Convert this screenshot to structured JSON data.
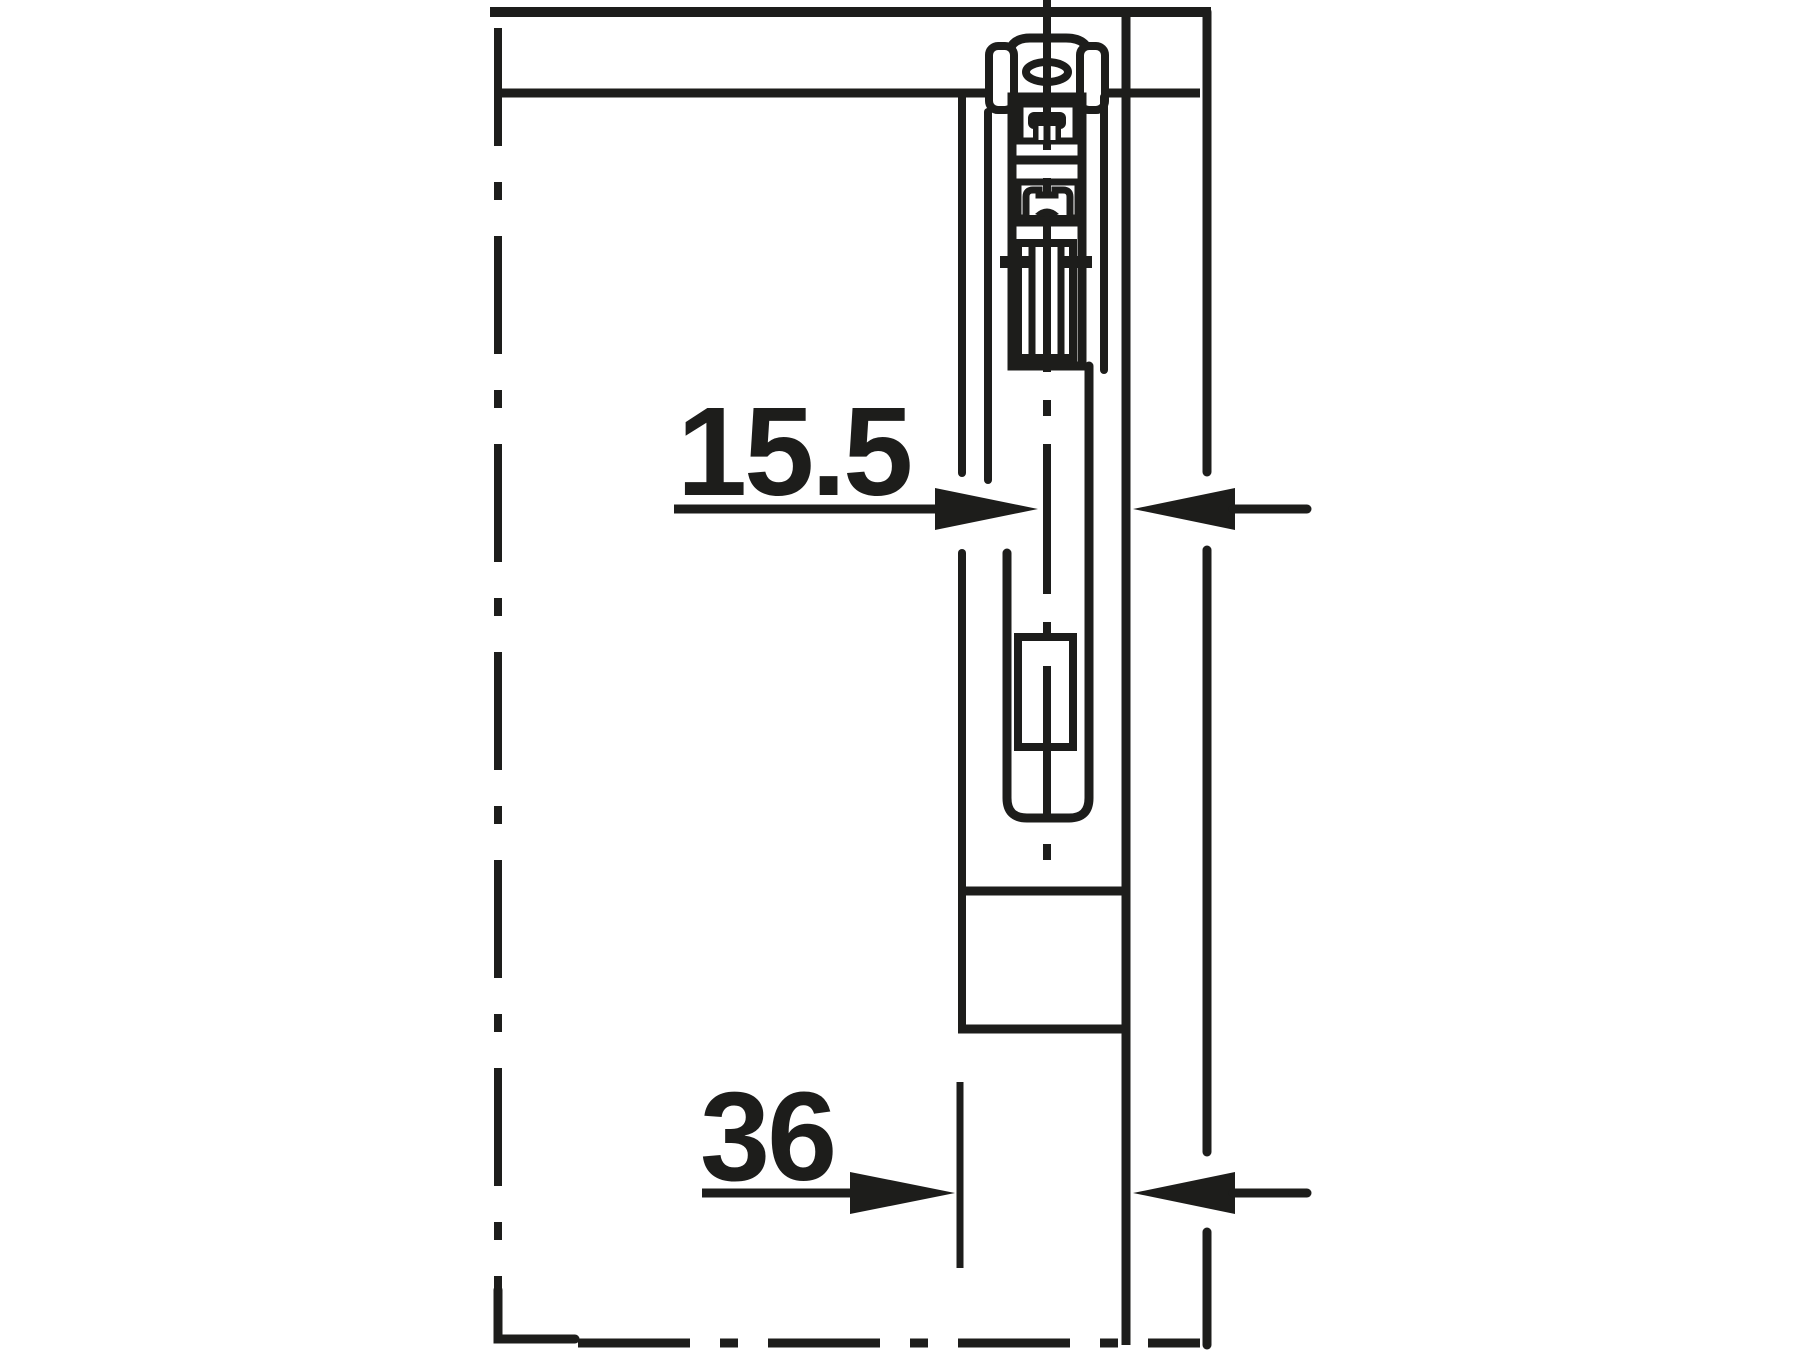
{
  "drawing": {
    "type": "technical-installation-drawing",
    "subject": "top-hung sliding door roller fitting, vertical cross-section",
    "ink_color": "#1d1d1b",
    "background_color": "#ffffff",
    "dimensions": [
      {
        "id": "runner-to-side-panel",
        "label": "15.5"
      },
      {
        "id": "door-face-to-side-panel",
        "label": "36"
      }
    ]
  }
}
